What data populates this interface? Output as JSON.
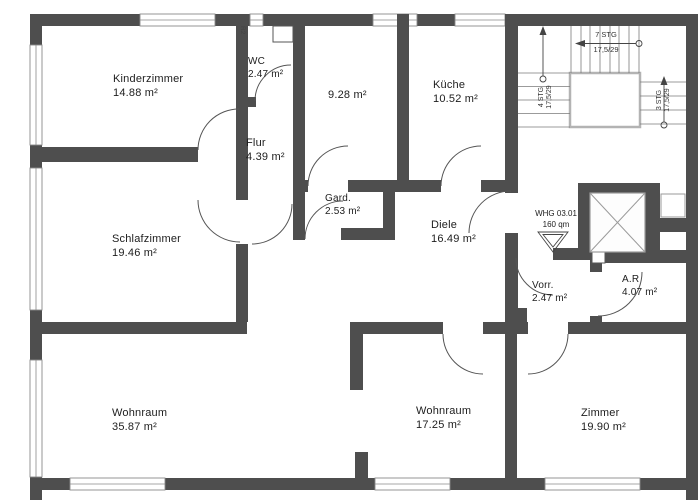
{
  "plan": {
    "apartment_marker": {
      "line1": "WHG 03.01",
      "line2": "160 qm"
    },
    "shaft_label": "R2",
    "rooms": [
      {
        "id": "kinderzimmer",
        "name": "Kinderzimmer",
        "area": "14.88 m²"
      },
      {
        "id": "wc",
        "name": "WC",
        "area": "2.47 m²"
      },
      {
        "id": "room-928",
        "name": "",
        "area": "9.28 m²"
      },
      {
        "id": "kueche",
        "name": "Küche",
        "area": "10.52 m²"
      },
      {
        "id": "flur",
        "name": "Flur",
        "area": "4.39 m²"
      },
      {
        "id": "garderobe",
        "name": "Gard.",
        "area": "2.53 m²"
      },
      {
        "id": "diele",
        "name": "Diele",
        "area": "16.49 m²"
      },
      {
        "id": "schlafzimmer",
        "name": "Schlafzimmer",
        "area": "19.46 m²"
      },
      {
        "id": "vorraum",
        "name": "Vorr.",
        "area": "2.47 m²"
      },
      {
        "id": "abstellraum",
        "name": "A.R",
        "area": "4.07 m²"
      },
      {
        "id": "wohnraum-1",
        "name": "Wohnraum",
        "area": "35.87 m²"
      },
      {
        "id": "wohnraum-2",
        "name": "Wohnraum",
        "area": "17.25 m²"
      },
      {
        "id": "zimmer",
        "name": "Zimmer",
        "area": "19.90 m²"
      }
    ],
    "stairs": {
      "up_run": {
        "steps": "7 STG",
        "tread": "17,5/29"
      },
      "left_run": {
        "steps": "4 STG",
        "tread": "17,5/29"
      },
      "right_run": {
        "steps": "3 STG",
        "tread": "17,5/29"
      }
    },
    "colors": {
      "wall": "#4e4e4e",
      "line": "#8a8a8a",
      "text": "#1d1d1d",
      "bg": "#ffffff"
    }
  }
}
